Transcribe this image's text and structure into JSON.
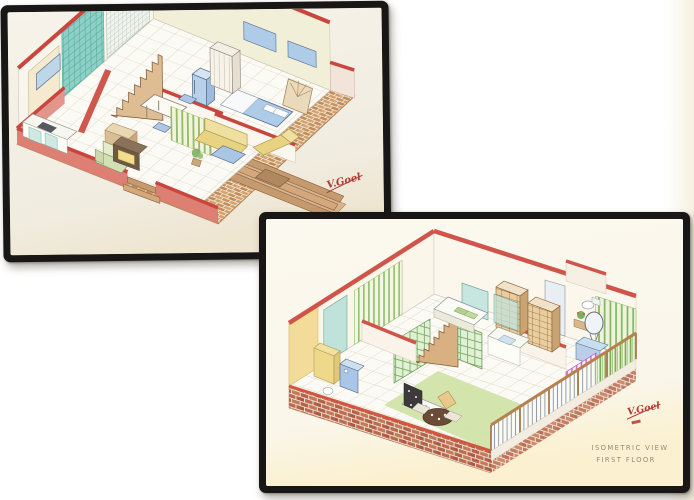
{
  "scene": {
    "description": "Two framed hand-drawn isometric house floor-plan drawings",
    "background_color": "#ffffff"
  },
  "drawings": [
    {
      "id": "ground-floor-drawing",
      "signature": "V.Goel",
      "caption_lines": []
    },
    {
      "id": "first-floor-drawing",
      "signature": "V.Goel",
      "caption_lines": [
        "ISOMETRIC VIEW",
        "FIRST FLOOR"
      ]
    }
  ],
  "palette": {
    "frame": "#181715",
    "paper": "#f4f1e8",
    "wall_red": "#c8463e",
    "wall_red2": "#d0544a",
    "brick_tan": "#cf9c6a",
    "brick_red": "#b5624a",
    "teal_tile": "#8fd0c6",
    "furniture_blue": "#aecbe8",
    "furniture_yellow": "#e8d382",
    "leaf_green": "#8fba6a",
    "floor_green": "#cfe2a6",
    "stair_tan": "#d9b082",
    "caption_ink": "#97896f",
    "signature_ink": "#b23a35"
  }
}
